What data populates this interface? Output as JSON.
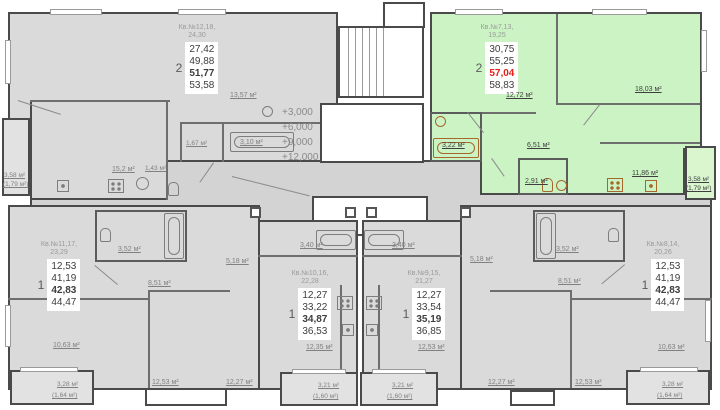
{
  "colors": {
    "highlight_fill": "#ccf3c4",
    "apartment_fill": "#dadada",
    "wall": "#4a4a4a",
    "selected_price": "#e32219"
  },
  "elevations": {
    "e1": "+3,000",
    "e2": "+6,000",
    "e3": "+9,000",
    "e4": "+12,000"
  },
  "apartments": {
    "apt_12_18": {
      "title1": "Кв.№12,18,",
      "title2": "24,30",
      "rooms": "2",
      "area1": "27,42",
      "area2": "49,88",
      "area3": "51,77",
      "area4": "53,58"
    },
    "apt_7_13": {
      "title1": "Кв.№7,13,",
      "title2": "19,25",
      "rooms": "2",
      "area1": "30,75",
      "area2": "55,25",
      "area3": "57,04",
      "area4": "58,83"
    },
    "apt_11_17": {
      "title1": "Кв.№11,17,",
      "title2": "23,29",
      "rooms": "1",
      "area1": "12,53",
      "area2": "41,19",
      "area3": "42,83",
      "area4": "44,47"
    },
    "apt_10_16": {
      "title1": "Кв.№10,16,",
      "title2": "22,28",
      "rooms": "1",
      "area1": "12,27",
      "area2": "33,22",
      "area3": "34,87",
      "area4": "36,53"
    },
    "apt_9_15": {
      "title1": "Кв.№9,15,",
      "title2": "21,27",
      "rooms": "1",
      "area1": "12,27",
      "area2": "33,54",
      "area3": "35,19",
      "area4": "36,85"
    },
    "apt_8_14": {
      "title1": "Кв.№8,14,",
      "title2": "20,26",
      "rooms": "1",
      "area1": "12,53",
      "area2": "41,19",
      "area3": "42,83",
      "area4": "44,47"
    }
  },
  "areas": {
    "a12_room": "13,57 м²",
    "a12_kitchen": "15,2 м²",
    "a12_wc1": "1,43 м²",
    "a12_wc2": "1,67 м²",
    "a12_bath": "3,10 м²",
    "a12_balc1": "3,58 м²",
    "a12_balc2": "(1,79 м²)",
    "a7_living": "12,72 м²",
    "a7_bed": "18,03 м²",
    "a7_bath": "3,22 м²",
    "a7_hall": "6,51 м²",
    "a7_wc": "2,91 м²",
    "a7_kitchen": "11,86 м²",
    "a7_balc1": "3,58 м²",
    "a7_balc2": "(1,79 м²)",
    "a11_bath": "3,52 м²",
    "a11_hall": "5,18 м²",
    "a11_corr": "8,51 м²",
    "a11_living": "10,63 м²",
    "a11_bed": "12,53 м²",
    "a11_balc1": "3,28 м²",
    "a11_balc2": "(1,64 м²)",
    "a10_bath": "3,40 м²",
    "a10_living": "12,35 м²",
    "a10_bed": "12,27 м²",
    "a10_balc1": "3,21 м²",
    "a10_balc2": "(1,60 м²)",
    "a9_bath": "3,40 м²",
    "a9_living": "12,53 м²",
    "a9_bed": "12,27 м²",
    "a9_balc1": "3,21 м²",
    "a9_balc2": "(1,60 м²)",
    "a8_bath": "3,52 м²",
    "a8_hall": "5,18 м²",
    "a8_corr": "8,51 м²",
    "a8_living": "10,63 м²",
    "a8_bed": "12,53 м²",
    "a8_balc1": "3,28 м²",
    "a8_balc2": "(1,64 м²)"
  }
}
